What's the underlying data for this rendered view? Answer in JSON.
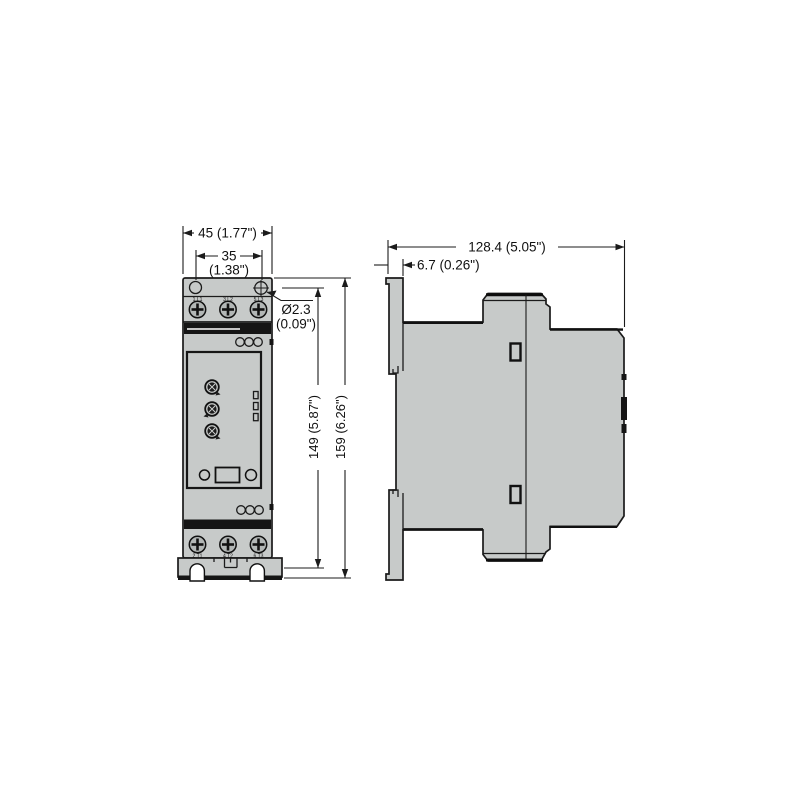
{
  "drawing": {
    "type": "technical-dimension-drawing",
    "views": {
      "left": "front view",
      "right": "side view"
    },
    "colors": {
      "background": "#ffffff",
      "body_fill": "#c7cac9",
      "line": "#1b1b1b",
      "band": "#151515"
    }
  },
  "dims": {
    "front_width": "45 (1.77\")",
    "hole_pitch": "35",
    "hole_pitch_in": "(1.38\")",
    "hole_dia": "Ø2.3",
    "hole_dia_in": "(0.09\")",
    "mount_height": "149 (5.87\")",
    "total_height": "159 (6.26\")",
    "depth": "128.4 (5.05\")",
    "front_offset": "6.7 (0.26\")"
  },
  "front_view": {
    "top_terminal_labels": [
      "1 L1",
      "3 L2",
      "5 L3"
    ],
    "bottom_terminal_labels": [
      "2 T1",
      "4 T2",
      "6 T3"
    ]
  }
}
